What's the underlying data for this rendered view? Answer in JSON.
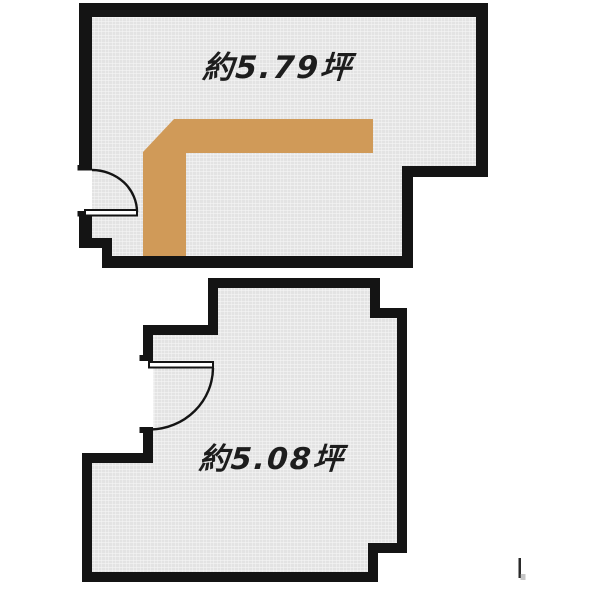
{
  "canvas": {
    "background": "#ffffff"
  },
  "colors": {
    "wall": "#141414",
    "floor_base": "#e3e3e3",
    "floor_grid": "#f8f8f8",
    "highlight": "#d09a58",
    "door_fill": "#ffffff",
    "label_text": "#1d1d1d",
    "artifact": "#2a2a2a",
    "artifact_smudge": "#a8a8a8"
  },
  "units": [
    {
      "name": "upper-unit",
      "area_label": "約5.79坪"
    },
    {
      "name": "lower-unit",
      "area_label": "約5.08坪"
    }
  ]
}
